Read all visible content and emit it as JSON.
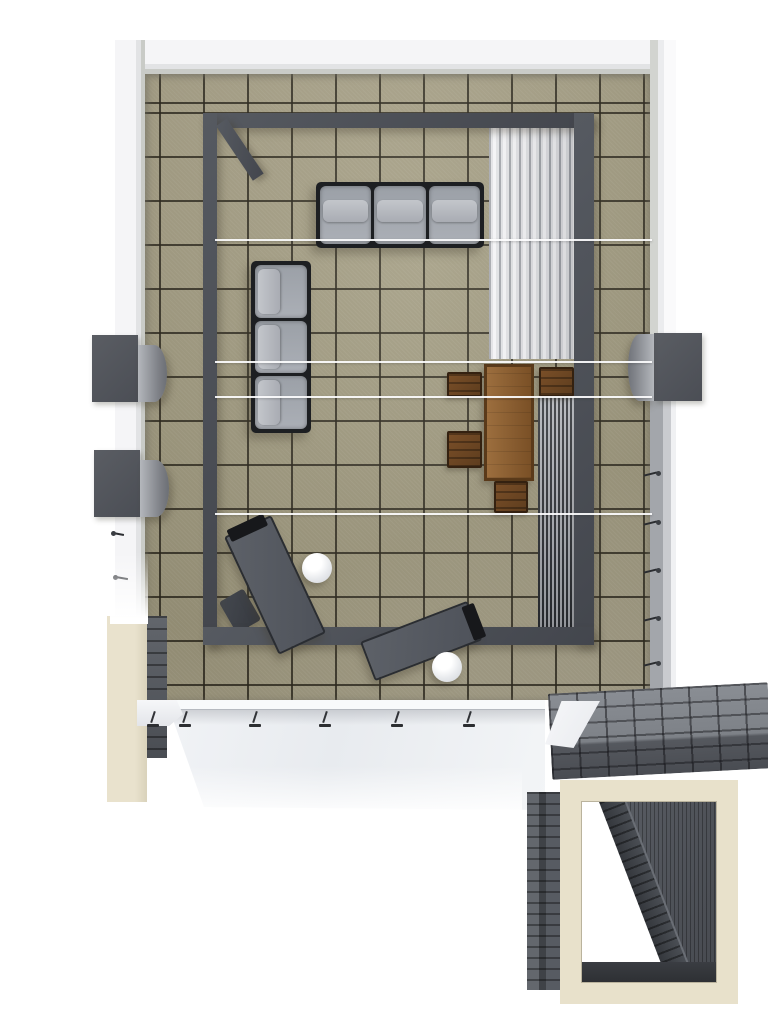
{
  "meta": {
    "type": "3d-architectural-floorplan-render",
    "view": "top-down",
    "subject": "roof terrace with pergola, lounge furniture and stair portal"
  },
  "palette": {
    "tile": "#a29b81",
    "wall": "#f2f2f4",
    "pergola": "#4c5057",
    "cushion": "#a2a6ad",
    "sofa-frame": "#1d1f22",
    "wood": "#8a5a30",
    "chair": "#6b4522",
    "louver-white": "#f2f2f4",
    "slat-dark": "#2c2f34",
    "stone": "#7c8086",
    "cream": "#e8e1cb",
    "canopy": "#edeff2",
    "railing": "#c6c8cc",
    "lounger": "#565a61"
  },
  "inventory": {
    "sofas": 2,
    "sofa_seats_each": 3,
    "dining_table": 1,
    "dining_chairs": 4,
    "sun_loungers": 2,
    "ottoman": 1,
    "round_side_tables": 2,
    "wall_planter_boxes": 3,
    "louver_panels": 2,
    "tension_wires": 4,
    "canopy_stanchions": 6,
    "railing_pins": 5,
    "stair_portal": 1
  },
  "geometry": {
    "wall_top": {
      "x": 115,
      "y": 40,
      "w": 561,
      "h": 34
    },
    "wall_left": {
      "x": 115,
      "y": 40,
      "w": 30,
      "h": 582
    },
    "wall_right": {
      "x": 650,
      "y": 40,
      "w": 26,
      "h": 302
    },
    "floor": {
      "x": 145,
      "y": 74,
      "w": 505,
      "h": 626
    },
    "railing": {
      "x": 650,
      "y": 342,
      "w": 26,
      "h": 358
    },
    "rail_pin_1": {
      "x": 644,
      "y": 470,
      "w": 18,
      "h": 8
    },
    "rail_pin_2": {
      "x": 644,
      "y": 519,
      "w": 18,
      "h": 8
    },
    "rail_pin_3": {
      "x": 644,
      "y": 567,
      "w": 18,
      "h": 8
    },
    "rail_pin_4": {
      "x": 644,
      "y": 615,
      "w": 18,
      "h": 8
    },
    "rail_pin_5": {
      "x": 644,
      "y": 660,
      "w": 18,
      "h": 8
    },
    "planter_left_1": {
      "x": 92,
      "y": 335,
      "w": 46,
      "h": 67
    },
    "planter_left_2": {
      "x": 94,
      "y": 450,
      "w": 46,
      "h": 67
    },
    "planter_right": {
      "x": 654,
      "y": 333,
      "w": 48,
      "h": 68
    },
    "pergola_top": {
      "x": 203,
      "y": 113,
      "w": 391,
      "h": 15
    },
    "pergola_left": {
      "x": 203,
      "y": 113,
      "w": 14,
      "h": 532
    },
    "pergola_right": {
      "x": 574,
      "y": 113,
      "w": 20,
      "h": 532
    },
    "pergola_bottom": {
      "x": 203,
      "y": 627,
      "w": 391,
      "h": 18
    },
    "pergola_brace": {
      "x": 216,
      "y": 126,
      "w": 13,
      "h": 66,
      "rot": -34
    },
    "louver_light": {
      "x": 489,
      "y": 126,
      "w": 85,
      "h": 233
    },
    "louver_dark": {
      "x": 538,
      "y": 397,
      "w": 39,
      "h": 234
    },
    "wire_1": {
      "x": 215,
      "y": 239,
      "w": 437,
      "h": 2
    },
    "wire_2": {
      "x": 215,
      "y": 361,
      "w": 437,
      "h": 2
    },
    "wire_3": {
      "x": 215,
      "y": 396,
      "w": 437,
      "h": 2
    },
    "wire_4": {
      "x": 215,
      "y": 513,
      "w": 437,
      "h": 2
    },
    "sofa_top": {
      "x": 316,
      "y": 182,
      "w": 168,
      "h": 66
    },
    "sofa_left": {
      "x": 251,
      "y": 261,
      "w": 60,
      "h": 172
    },
    "dining_table": {
      "x": 484,
      "y": 364,
      "w": 50,
      "h": 117
    },
    "chair_north": {
      "x": 539,
      "y": 367,
      "w": 35,
      "h": 30
    },
    "chair_west_1": {
      "x": 447,
      "y": 372,
      "w": 35,
      "h": 25
    },
    "chair_west_2": {
      "x": 447,
      "y": 431,
      "w": 35,
      "h": 37
    },
    "chair_south": {
      "x": 494,
      "y": 481,
      "w": 34,
      "h": 32
    },
    "lounger_1": {
      "x": 224,
      "y": 537,
      "w": 52,
      "h": 130,
      "rot": -25
    },
    "lounger_2": {
      "x": 360,
      "y": 642,
      "w": 115,
      "h": 42,
      "rot": -21
    },
    "ottoman": {
      "x": 226,
      "y": 593,
      "w": 28,
      "h": 36,
      "rot": -30
    },
    "side_table_1": {
      "x": 302,
      "y": 553,
      "w": 30,
      "h": 30
    },
    "side_table_2": {
      "x": 432,
      "y": 652,
      "w": 30,
      "h": 30
    },
    "hook_1": {
      "x": 111,
      "y": 529,
      "w": 17,
      "h": 10
    },
    "hook_2": {
      "x": 113,
      "y": 573,
      "w": 19,
      "h": 10
    },
    "column": {
      "x": 107,
      "y": 616,
      "w": 40,
      "h": 186
    },
    "stone_strip": {
      "x": 147,
      "y": 616,
      "w": 20,
      "h": 142
    },
    "ledge": {
      "x": 137,
      "y": 700,
      "w": 46,
      "h": 26
    },
    "canopy": {
      "x": 160,
      "y": 700,
      "w": 385,
      "h": 110
    },
    "stanchion_1": {
      "x": 146,
      "y": 711,
      "w": 14,
      "h": 18
    },
    "stanchion_2": {
      "x": 178,
      "y": 711,
      "w": 14,
      "h": 18
    },
    "stanchion_3": {
      "x": 248,
      "y": 711,
      "w": 14,
      "h": 18
    },
    "stanchion_4": {
      "x": 318,
      "y": 711,
      "w": 14,
      "h": 18
    },
    "stanchion_5": {
      "x": 390,
      "y": 711,
      "w": 14,
      "h": 18
    },
    "stanchion_6": {
      "x": 462,
      "y": 711,
      "w": 14,
      "h": 18
    },
    "wedge": {
      "x": 545,
      "y": 701,
      "w": 55,
      "h": 47
    },
    "bridge": {
      "x": 550,
      "y": 688,
      "w": 220,
      "h": 86,
      "rot": -3
    },
    "portal": {
      "x": 560,
      "y": 780,
      "w": 178,
      "h": 224
    },
    "portal_legs": {
      "x": 527,
      "y": 792,
      "w": 35,
      "h": 198
    },
    "fade_wall": {
      "x": 110,
      "y": 552,
      "w": 38,
      "h": 72
    },
    "fade_canopy": {
      "x": 150,
      "y": 766,
      "w": 372,
      "h": 58
    }
  }
}
